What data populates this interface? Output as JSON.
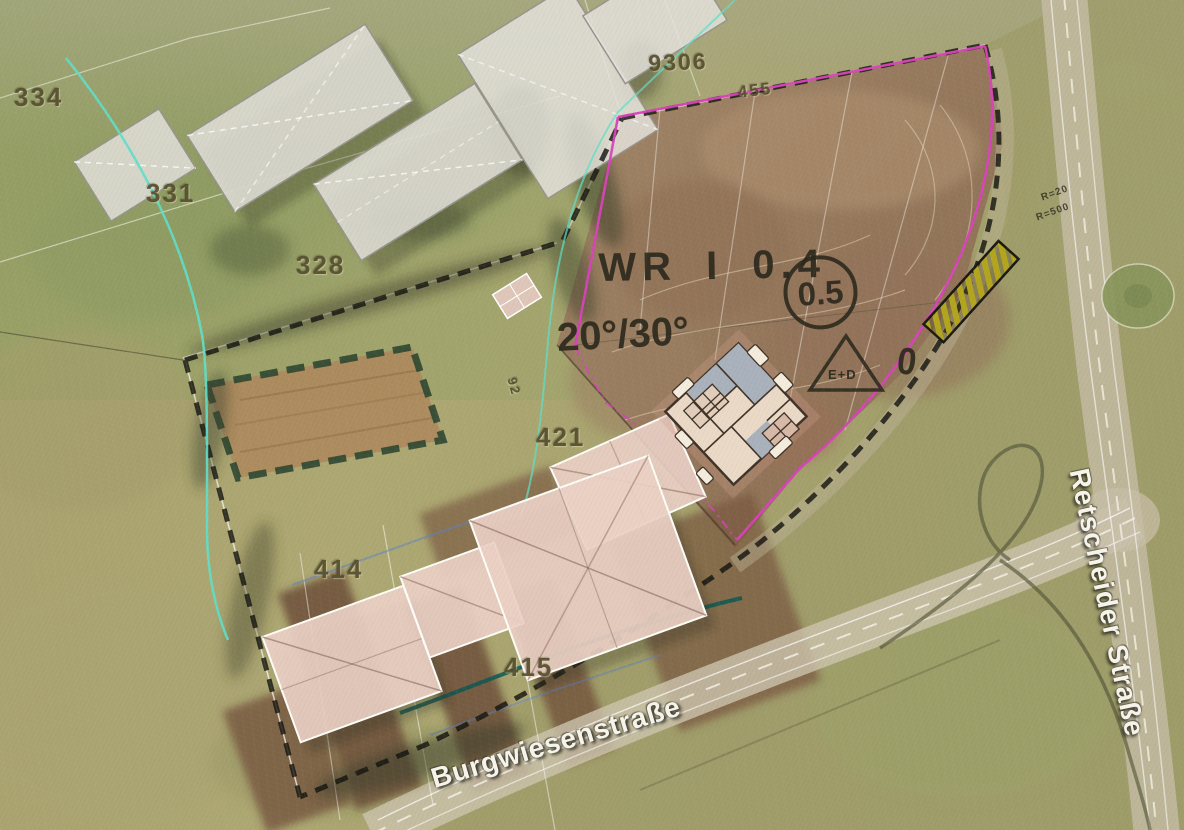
{
  "map_labels": {
    "parcels": [
      {
        "text": "334"
      },
      {
        "text": "331"
      },
      {
        "text": "328"
      },
      {
        "text": "9306"
      },
      {
        "text": "455"
      },
      {
        "text": "421"
      },
      {
        "text": "92"
      },
      {
        "text": "414"
      },
      {
        "text": "415"
      }
    ],
    "plan": {
      "zone": "WR I 0.4",
      "circled_value": "0.5",
      "roof_pitch": "20°/30°",
      "triangle": "E+D",
      "marker": "0"
    },
    "streets": [
      {
        "name": "Burgwiesenstraße"
      },
      {
        "name": "Retscheider Straße"
      }
    ],
    "road_annotations": [
      {
        "text": "R=20"
      },
      {
        "text": "R=500"
      }
    ]
  },
  "legend_colors": {
    "plan_boundary_magenta": "#da41bd",
    "survey_line_cyan": "#5fdfc9",
    "utility_line_teal": "#0d5751",
    "restriction_hatch_yellow": "#b3a51d",
    "garden_border_green": "#2a4430",
    "boundary_dashed_black": "#15150f",
    "plan_ink": "#2b2a1e",
    "planned_building_roof": "#ebd0c6",
    "existing_building_fill": "#dedbd4"
  }
}
